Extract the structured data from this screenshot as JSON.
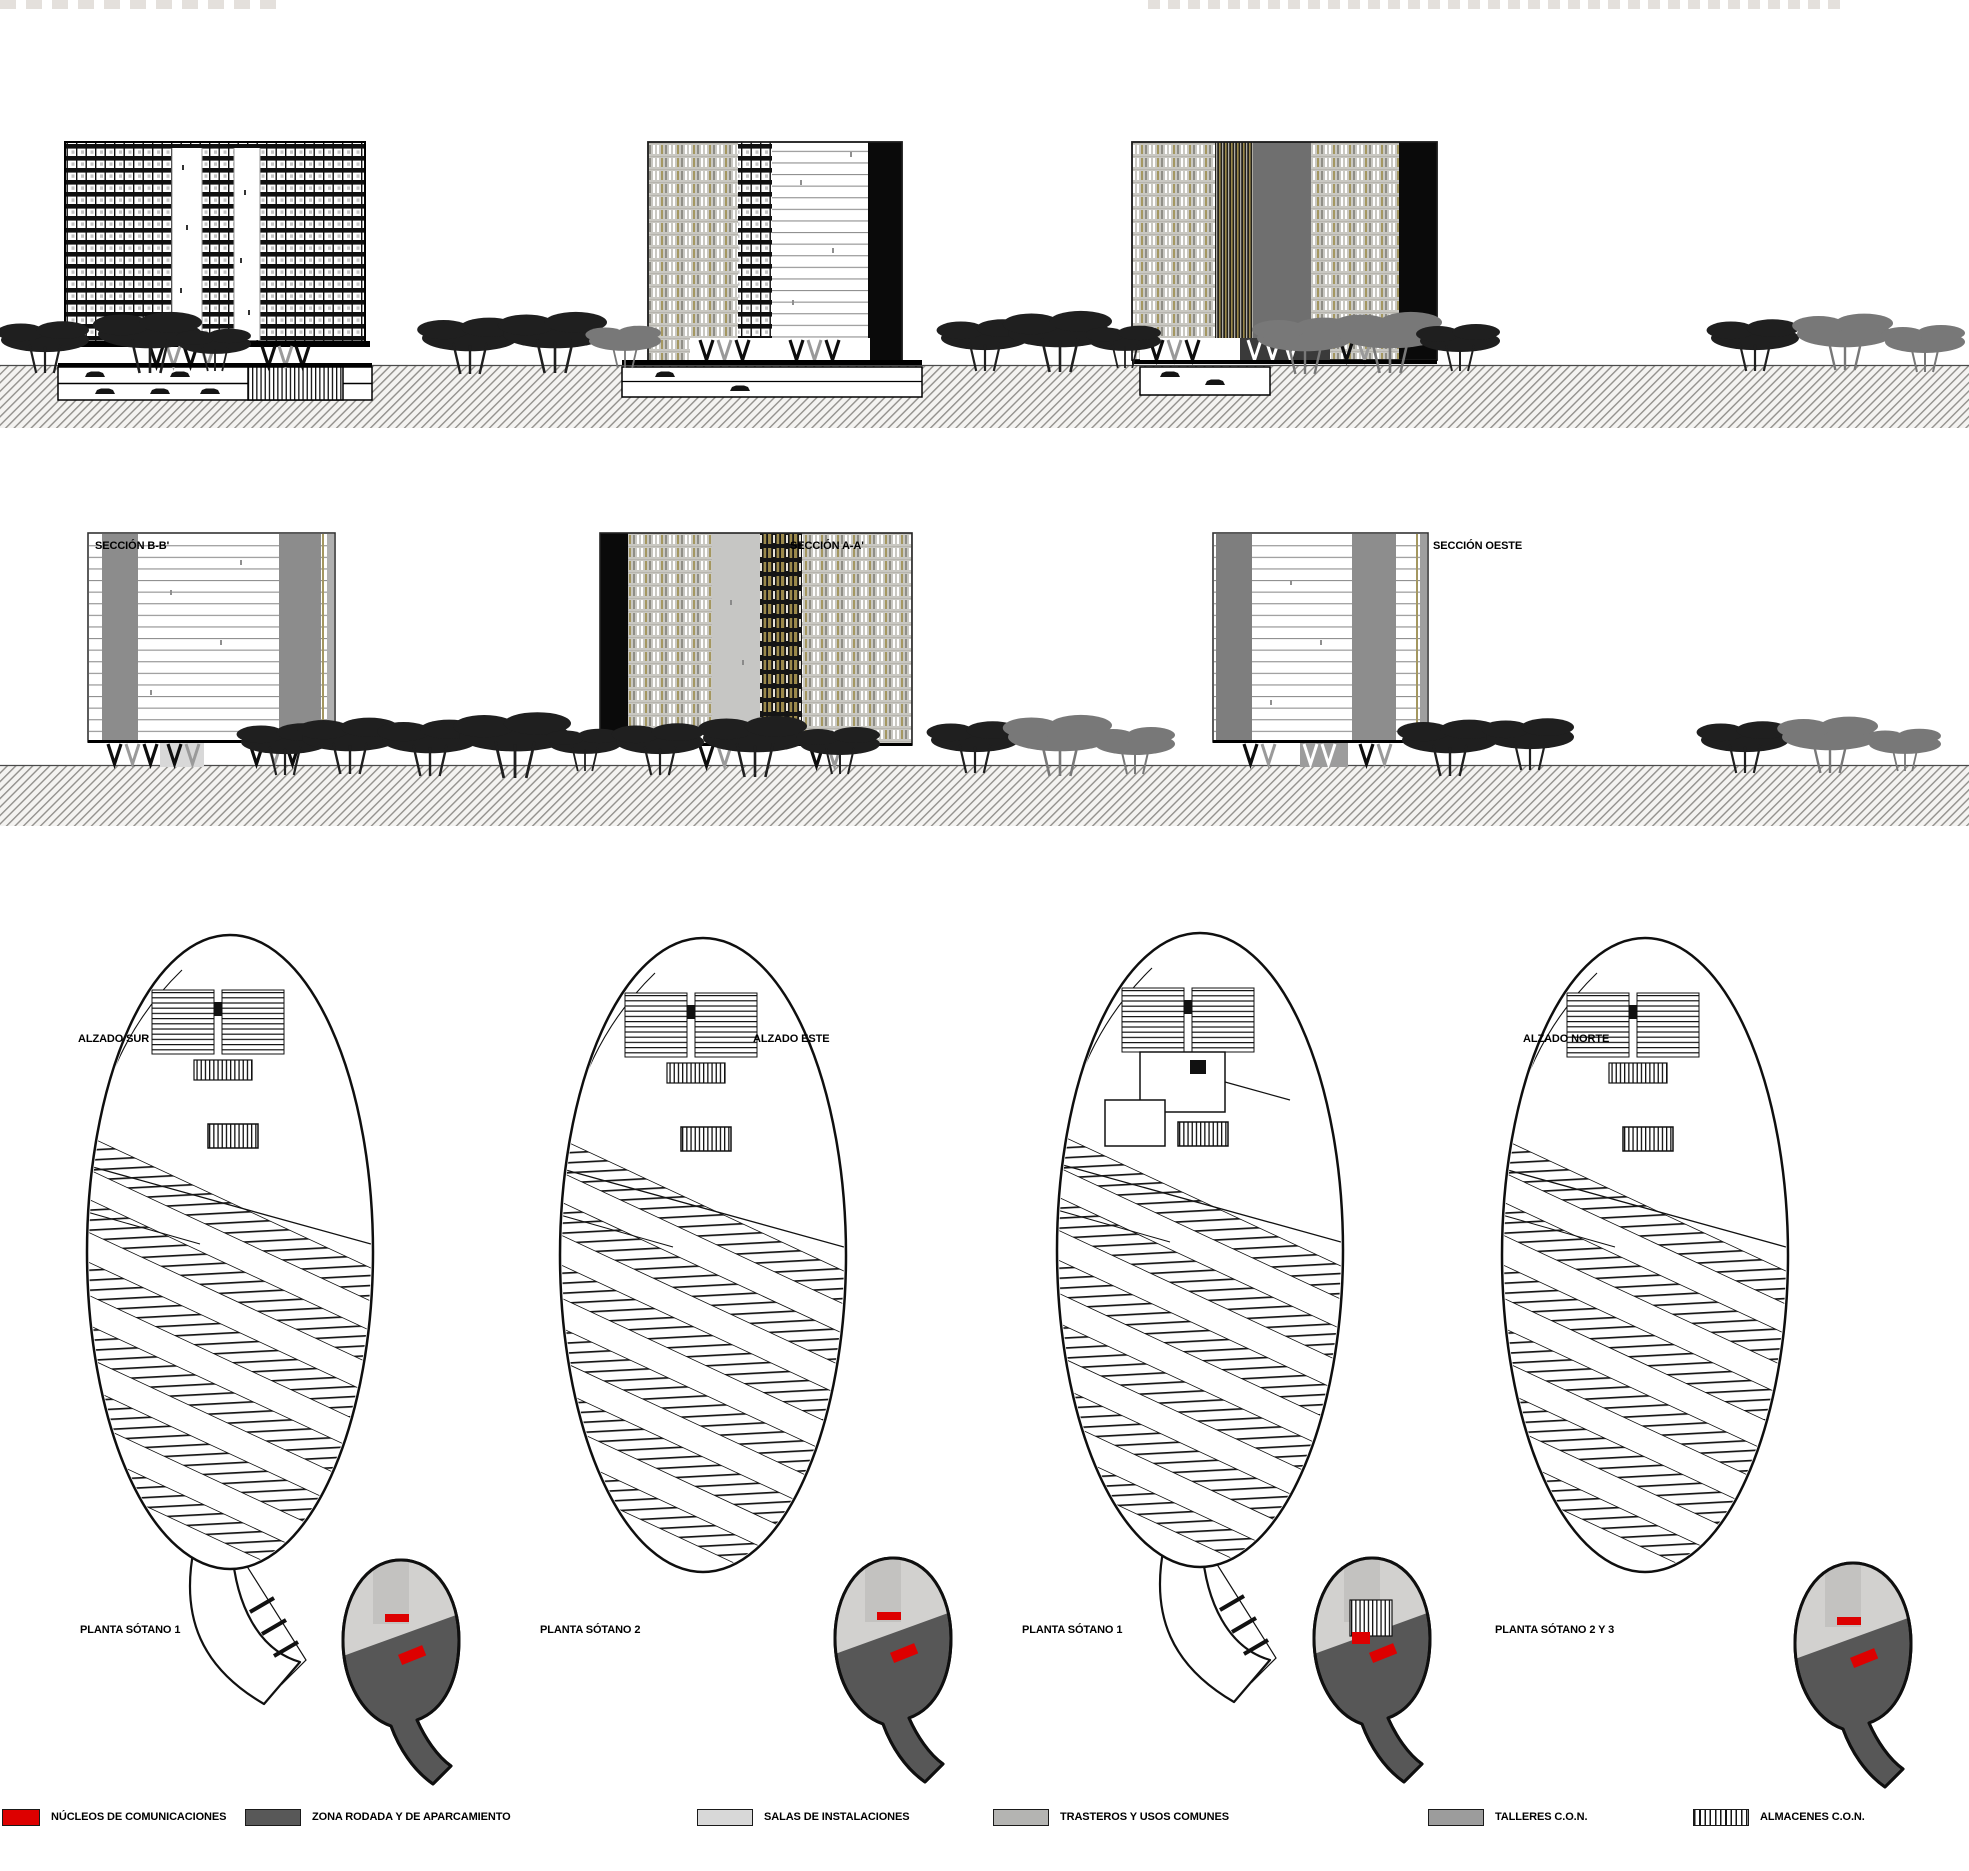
{
  "sections": {
    "row1": [
      {
        "id": "seccion-bb",
        "label": "SECCIÓN B-B'"
      },
      {
        "id": "seccion-aa",
        "label": "SECCIÓN A-A'"
      },
      {
        "id": "seccion-oeste",
        "label": "SECCIÓN OESTE"
      }
    ],
    "row2": [
      {
        "id": "alzado-sur",
        "label": "ALZADO SUR"
      },
      {
        "id": "alzado-este",
        "label": "ALZADO ESTE"
      },
      {
        "id": "alzado-norte",
        "label": "ALZADO NORTE"
      }
    ],
    "row3": [
      {
        "id": "planta-sotano-1a",
        "label": "PLANTA SÓTANO 1"
      },
      {
        "id": "planta-sotano-2",
        "label": "PLANTA SÓTANO 2"
      },
      {
        "id": "planta-sotano-1b",
        "label": "PLANTA SÓTANO 1"
      },
      {
        "id": "planta-sotano-2y3",
        "label": "PLANTA SÓTANO 2 Y 3"
      }
    ]
  },
  "legend": {
    "items": [
      {
        "label": "NÚCLEOS DE COMUNICACIONES",
        "color": "#dd0000",
        "pattern": "solid"
      },
      {
        "label": "ZONA RODADA Y DE APARCAMIENTO",
        "color": "#585858",
        "pattern": "solid"
      },
      {
        "label": "SALAS DE INSTALACIONES",
        "color": "#d8d8d8",
        "pattern": "solid"
      },
      {
        "label": "TRASTEROS Y USOS COMUNES",
        "color": "#b4b4b2",
        "pattern": "solid"
      },
      {
        "label": "TALLERES C.O.N.",
        "color": "#9c9c9c",
        "pattern": "solid"
      },
      {
        "label": "ALMACENES C.O.N.",
        "color": "#ffffff",
        "pattern": "vertical-hatch"
      }
    ]
  },
  "colors": {
    "accent_red": "#dd0000",
    "olive_facade": "#a49760",
    "gold_facade": "#9b894b",
    "ink": "#111111",
    "ground_hatch": "#92908c"
  }
}
